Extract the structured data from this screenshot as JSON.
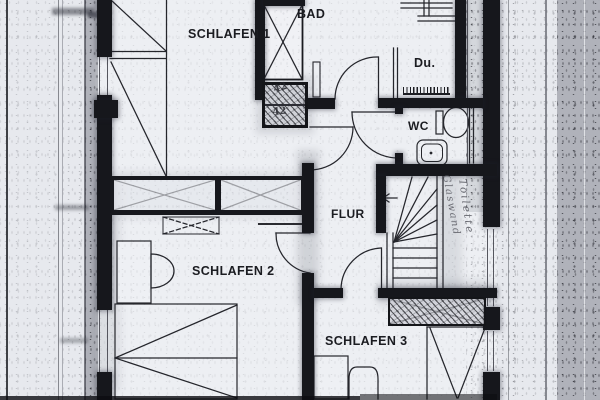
{
  "document": {
    "type": "Scanned architectural floor plan",
    "language": "German"
  },
  "rooms": [
    {
      "id": "schlafen1",
      "label": "SCHLAFEN 1"
    },
    {
      "id": "bad",
      "label": "BAD"
    },
    {
      "id": "dusche",
      "label": "Du."
    },
    {
      "id": "wc",
      "label": "WC"
    },
    {
      "id": "flur",
      "label": "FLUR"
    },
    {
      "id": "schlafen2",
      "label": "SCHLAFEN 2"
    },
    {
      "id": "schlafen3",
      "label": "SCHLAFEN 3"
    }
  ],
  "annotations": {
    "flue_marks": [
      "42",
      "42"
    ],
    "handwritten_vertical": [
      "Glaswand",
      "Toilette"
    ]
  },
  "colors": {
    "paper": "#e7e9ee",
    "ink": "#16171c",
    "pencil": "#53545c"
  }
}
